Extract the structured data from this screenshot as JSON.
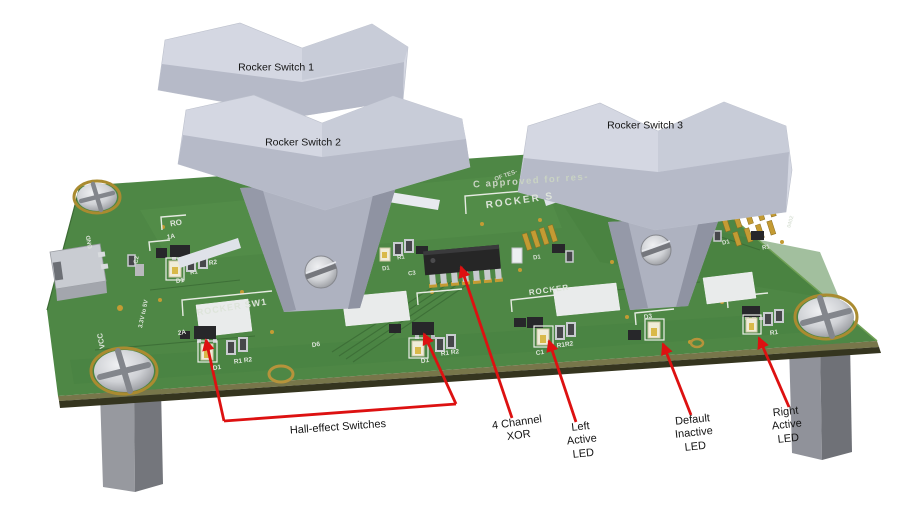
{
  "figure": {
    "background": "#ffffff"
  },
  "colors": {
    "pcb_green": "#4e8745",
    "annotation_red": "#dd1111",
    "rocker_gray": "#d4d7e2",
    "standoff_gray": "#90929a",
    "gold_pad": "#c49b33"
  },
  "rocker_switches": [
    {
      "label": "Rocker Switch 1"
    },
    {
      "label": "Rocker Switch 2"
    },
    {
      "label": "Rocker Switch 3"
    }
  ],
  "annotations": {
    "hall": {
      "label": "Hall-effect Switches"
    },
    "xor": {
      "label": "4 Channel\nXOR"
    },
    "left_led": {
      "label": "Left\nActive\nLED"
    },
    "default_led": {
      "label": "Default\nInactive\nLED"
    },
    "right_led": {
      "label": "Right\nActive\nLED"
    }
  },
  "silkscreen": {
    "approved": "C approved for res-",
    "rocker_s": "ROCKER S",
    "rocker_sw1": "ROCKER SW1",
    "rocker3": "ROCKER",
    "rocker1_frag": "RO",
    "of_tes": "OF TES-",
    "vcc": "VCC",
    "vrange": "3.3V to 5V",
    "gnd": "GND",
    "p1a": "1A",
    "p2a": "2A",
    "c2": "C2",
    "d1_a": "D1",
    "r1_a": "R1",
    "r2_a": "R2",
    "d1_b": "D1",
    "r1r2_b": "R1 R2",
    "d6": "D6",
    "d1_c": "D1",
    "r1r2_c": "R1 R2",
    "c1": "C1",
    "r1r2_d": "R1R2",
    "d3": "D3",
    "r1_f": "R1",
    "d1_i": "D1",
    "r1_i": "R1",
    "d1_h": "D1",
    "d1_g": "D1",
    "c3": "C3",
    "r1_g": "R1",
    "pkg0402": "0402"
  }
}
